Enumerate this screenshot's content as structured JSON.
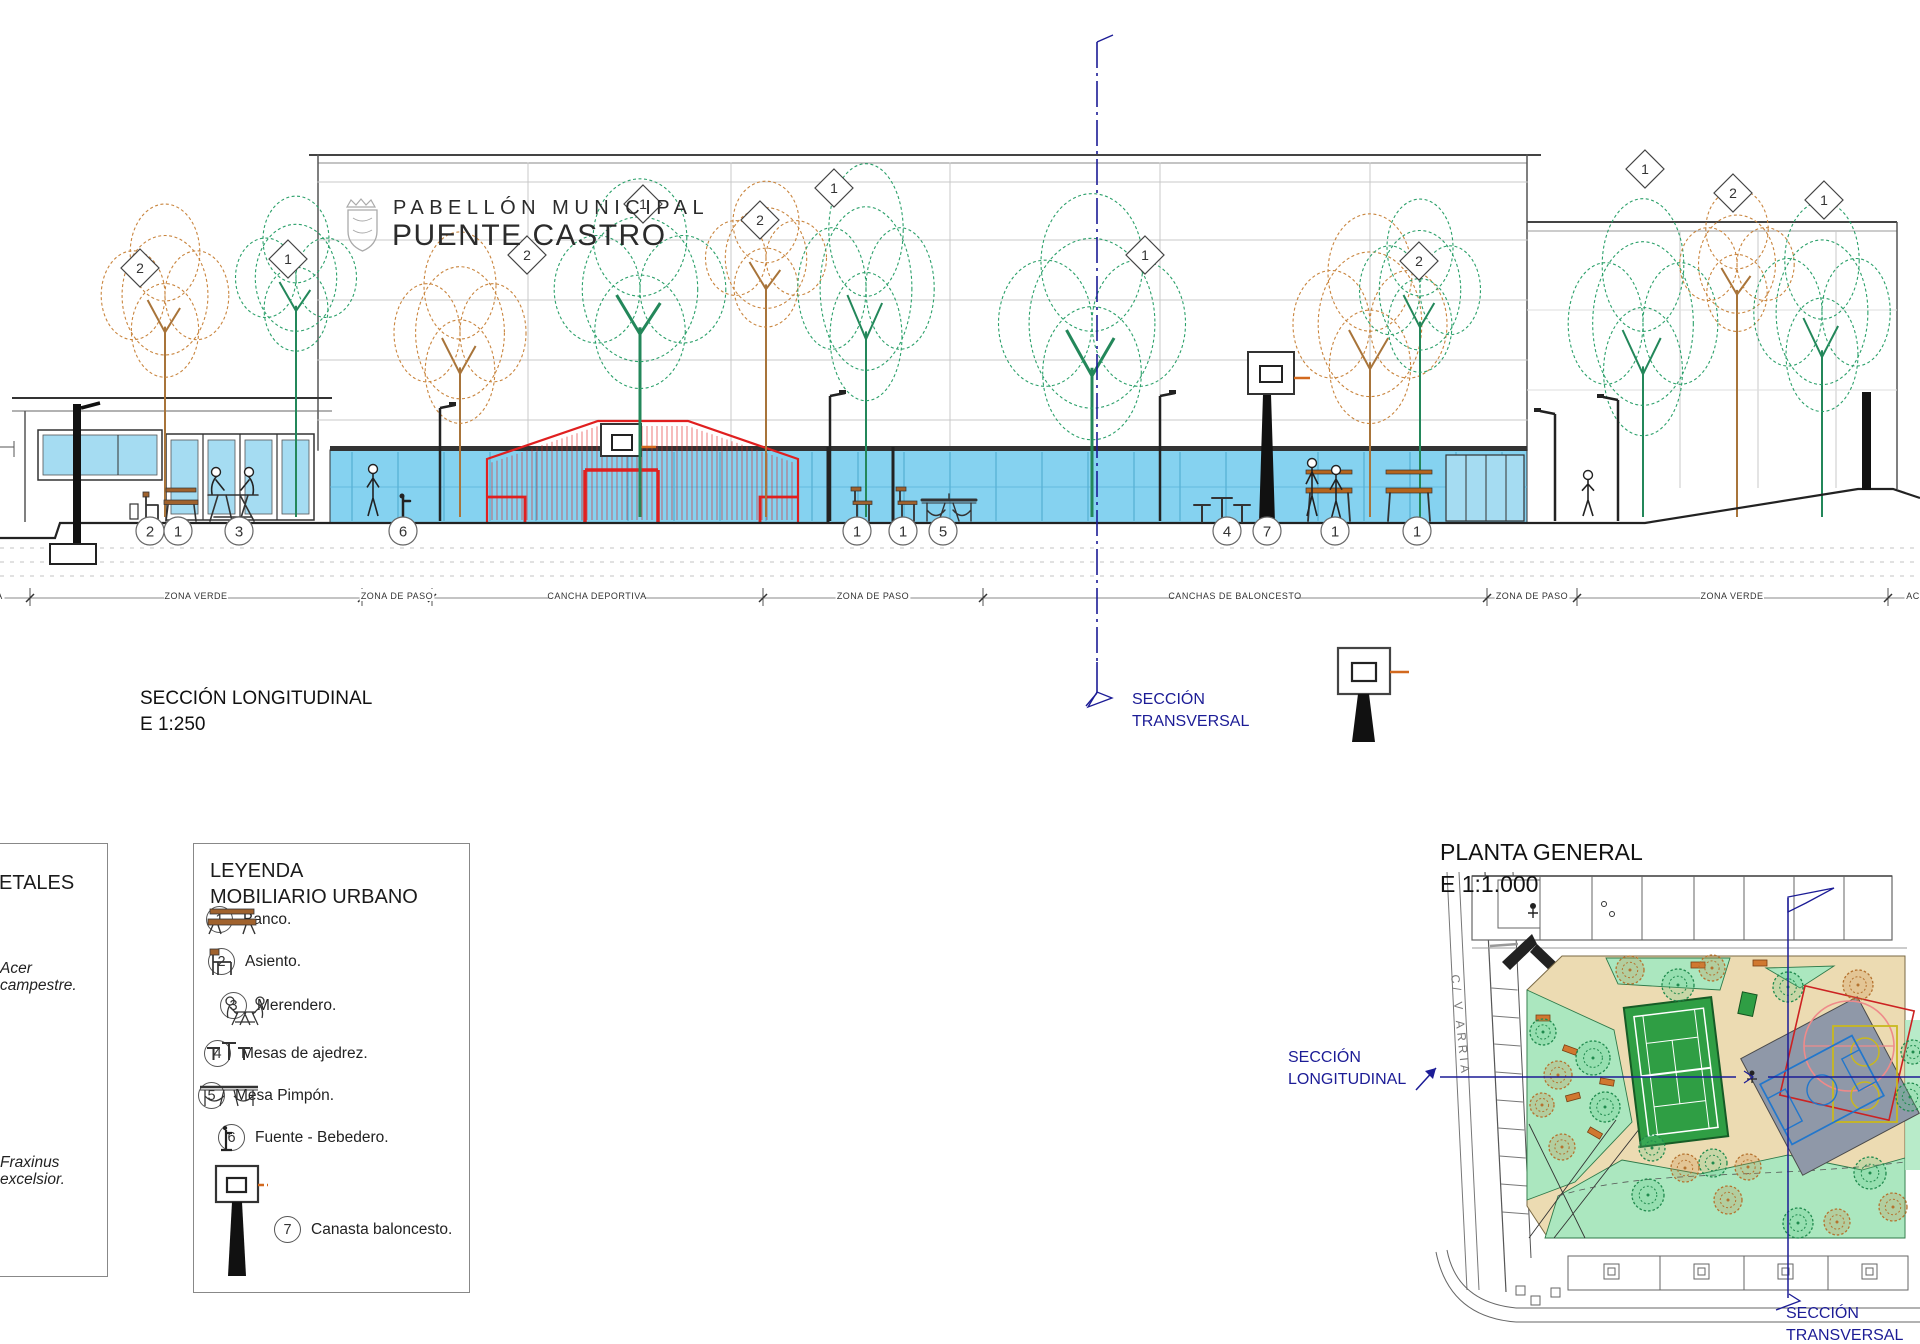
{
  "drawing": {
    "building_title_line1": "PABELLÓN MUNICIPAL",
    "building_title_line2": "PUENTE CASTRO",
    "section_label": "SECCIÓN LONGITUDINAL",
    "section_scale": "E 1:250",
    "transversal_line1": "SECCIÓN",
    "transversal_line2": "TRANSVERSAL",
    "zone_labels": [
      "ACERA",
      "ZONA VERDE",
      "ZONA DE PASO",
      "CANCHA DEPORTIVA",
      "ZONA DE PASO",
      "CANCHAS DE BALONCESTO",
      "ZONA DE PASO",
      "ZONA VERDE",
      "ACERA"
    ],
    "furniture_markers": [
      "2",
      "1",
      "3",
      "6",
      "1",
      "1",
      "5",
      "4",
      "7",
      "1",
      "1"
    ],
    "tree_tags": [
      "2",
      "1",
      "2",
      "1",
      "2",
      "1",
      "1",
      "2",
      "1",
      "2",
      "1"
    ]
  },
  "legend_species": {
    "title_visible": "ETALES",
    "entries": [
      "Acer campestre.",
      "Fraxinus excelsior."
    ]
  },
  "legend_furniture": {
    "title_line1": "LEYENDA",
    "title_line2": "MOBILIARIO URBANO",
    "items": [
      {
        "num": "1",
        "label": "Banco."
      },
      {
        "num": "2",
        "label": "Asiento."
      },
      {
        "num": "3",
        "label": "Merendero."
      },
      {
        "num": "4",
        "label": "Mesas de ajedrez."
      },
      {
        "num": "5",
        "label": "Mesa Pimpón."
      },
      {
        "num": "6",
        "label": "Fuente - Bebedero."
      },
      {
        "num": "7",
        "label": "Canasta baloncesto."
      }
    ]
  },
  "plan": {
    "title": "PLANTA GENERAL",
    "scale": "E 1:1.000",
    "street_label": "C/ V ARRIA",
    "longitudinal_line1": "SECCIÓN",
    "longitudinal_line2": "LONGITUDINAL",
    "transversal_line1": "SECCIÓN",
    "transversal_line2": "TRANSVERSAL"
  },
  "colors": {
    "section_line_blue": "#1c1c96",
    "glass_blue": "#85d2f0",
    "cage_red": "#e02020",
    "rim_orange": "#d2691e",
    "tree_green": "#2ba06a",
    "tree_orange": "#c9853e",
    "plaza_tan": "#ecdbb2",
    "lawn_green": "#abe7bf",
    "court_green": "#2f9e44"
  }
}
